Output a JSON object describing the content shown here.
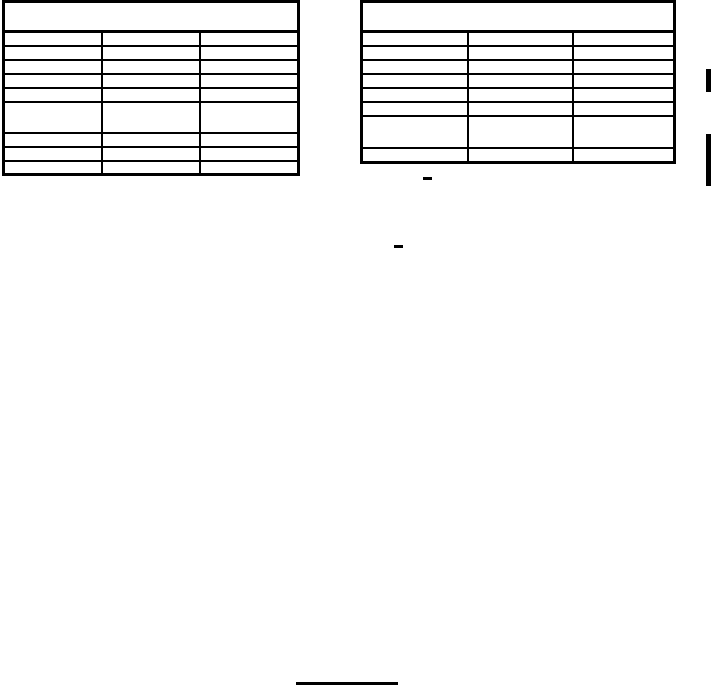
{
  "page": {
    "background_color": "#ffffff",
    "ink_color": "#000000",
    "visible_text": ""
  },
  "left_table": {
    "header_title": "",
    "column_count": 3,
    "rows": [
      [
        "",
        "",
        ""
      ],
      [
        "",
        "",
        ""
      ],
      [
        "",
        "",
        ""
      ],
      [
        "",
        "",
        ""
      ],
      [
        "",
        "",
        ""
      ],
      [
        "",
        "",
        ""
      ],
      [
        "",
        "",
        ""
      ],
      [
        "",
        "",
        ""
      ],
      [
        "",
        "",
        ""
      ]
    ]
  },
  "right_table": {
    "header_title": "",
    "column_count": 3,
    "rows": [
      [
        "",
        "",
        ""
      ],
      [
        "",
        "",
        ""
      ],
      [
        "",
        "",
        ""
      ],
      [
        "",
        "",
        ""
      ],
      [
        "",
        "",
        ""
      ],
      [
        "",
        "",
        ""
      ],
      [
        "",
        "",
        ""
      ],
      [
        "",
        "",
        ""
      ]
    ]
  },
  "marks": {
    "cell_dash": "small dash artifact in last row of right table",
    "stray_dash": "small dash artifact below right table",
    "footer_rule": "horizontal rule at bottom center",
    "change_bar_short": "short change bar in right margin",
    "change_bar_long": "long change bar in right margin"
  }
}
